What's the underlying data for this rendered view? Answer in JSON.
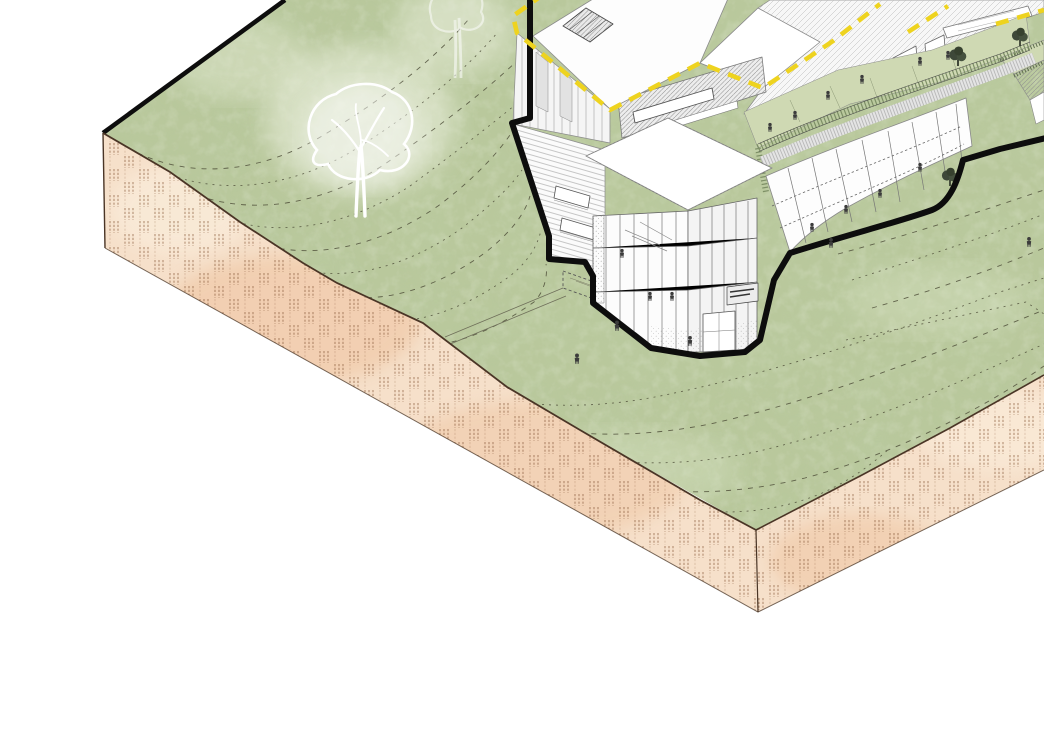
{
  "scene": {
    "description": "Architectural axonometric cutaway illustration: multi-storey building on a grassy hillside above a sectioned earth block",
    "background_color": "#ffffff",
    "palette": {
      "grass": "#b9c89c",
      "grass_shadow": "#7f9a5f",
      "grass_highlight": "#e3ebd2",
      "earth": "#f6e0ca",
      "earth_patch": "#eec29e",
      "earth_hatch": "#8d5f3f",
      "earth_edge": "#4a3526",
      "section_outline": "#0d0d0d",
      "boundary_yellow": "#eed31f",
      "drawing_line": "#6a6a6a",
      "drawing_line_light": "#9a9a9a",
      "terrace_green": "#cfd9b3",
      "railing_green": "#7d8f66",
      "contour_line": "#4f4f3a",
      "figure": "#3c3c3c",
      "tree_outline": "#ffffff",
      "shrub_dark": "#3e4839"
    }
  },
  "terrain": {
    "grass_surface": {
      "label": "hillside lawn",
      "contour_line_count": 18,
      "contour_style": "dashed"
    },
    "earth_block": {
      "label": "sectioned earth plinth",
      "visible_faces": 2,
      "hatch_style": "broken vertical dash columns in alternating bands"
    },
    "footpath": {
      "label": "footpath traces with stepped landing",
      "count": 2
    }
  },
  "vegetation": {
    "ghost_trees": [
      {
        "label": "large white-outline tree on lawn"
      },
      {
        "label": "faint white-outline tree at top edge"
      }
    ],
    "dark_trees": [
      {
        "label": "terrace tree"
      },
      {
        "label": "terrace tree"
      },
      {
        "label": "planter shrub at facade end"
      }
    ]
  },
  "building": {
    "label": "building cutaway in fine linework",
    "section_outline_style": "thick black cut line around building footprint",
    "site_boundary_style": "yellow dashed line along roof edges",
    "parts": [
      "flat roof with hatched skylight",
      "upper block facade",
      "striped side wall with recessed windows",
      "clerestory band wall",
      "valley roof",
      "glazed atrium tower with interior stair",
      "curved glazed wing",
      "green roof walkway with slat railing",
      "stepped roof terraces",
      "rear hatched roofs with glazed doors",
      "rooftop clerestory monitor"
    ],
    "signage": {
      "legible": false
    },
    "figure_count": 18
  }
}
